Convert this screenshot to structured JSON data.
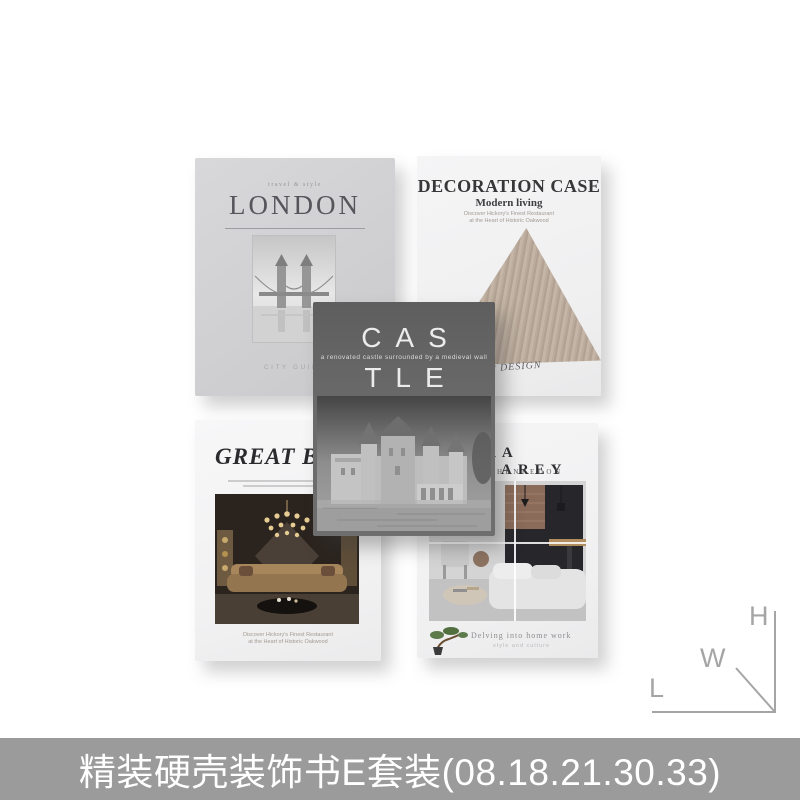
{
  "page": {
    "background_color": "#ffffff",
    "caption_bar_color": "#9b9b9b",
    "caption_text_color": "#ffffff"
  },
  "caption": {
    "text": "精装硬壳装饰书E套装(08.18.21.30.33)"
  },
  "watermark": {
    "letter_h": "H",
    "letter_w": "W",
    "letter_l": "L",
    "color": "#a5a5a5"
  },
  "books": {
    "london": {
      "tagline": "travel & style",
      "title": "LONDON",
      "footer": "CITY GUIDE",
      "cover_color": "#d2d2d4"
    },
    "decoration_case": {
      "title": "DECORATION CASE",
      "subtitle": "Modern living",
      "blurb_line1": "Discover Hickory's Finest Restaurant",
      "blurb_line2": "at the Heart of Historic Oakwood",
      "footer_script": "TOP DESIGN",
      "cover_color": "#f2f2f3",
      "wood_color": "#bcab9c"
    },
    "castle": {
      "title_line1": "CAS",
      "tagline": "a renovated castle surrounded by a medieval wall",
      "title_line2": "TLE",
      "cover_color": "#666666"
    },
    "great_britain": {
      "title": "GREAT BRI",
      "blurb_line1": "Discover Hickory's Finest Restaurant",
      "blurb_line2": "at the Heart of Historic Oakwood",
      "cover_color": "#f4f4f5"
    },
    "sara_barey": {
      "title": "RA BAREY",
      "subtitle": "HENREDON",
      "footer": "Delving into home work",
      "footer_sub": "style and culture",
      "cover_color": "#f2f2f3"
    }
  }
}
